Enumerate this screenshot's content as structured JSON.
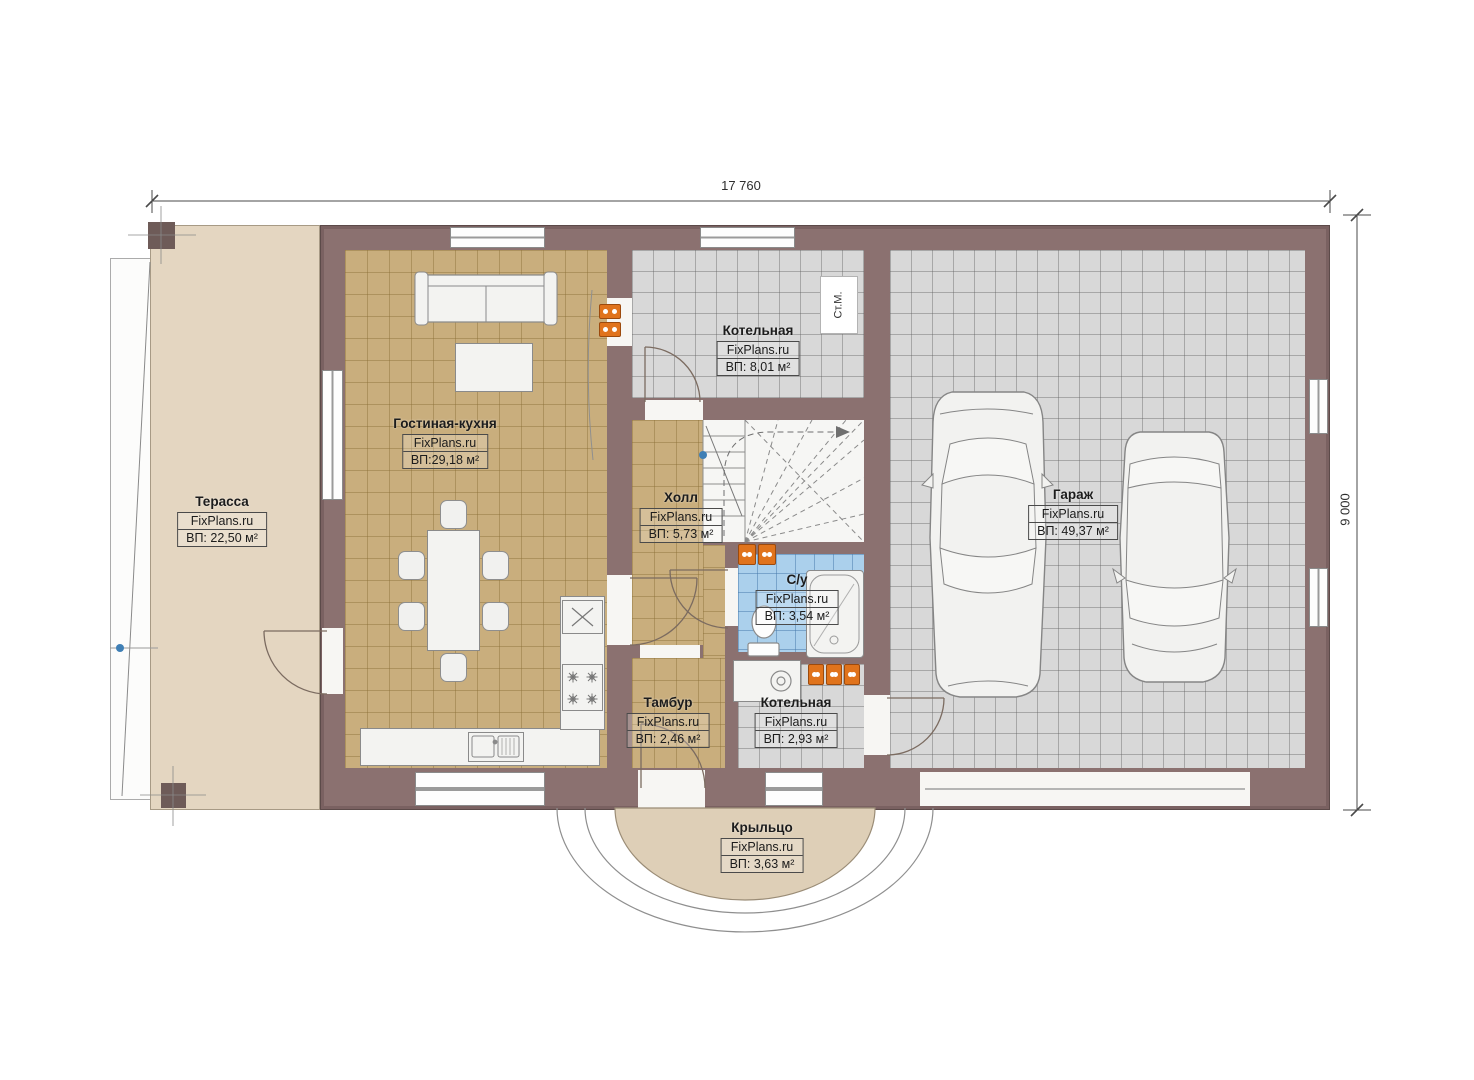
{
  "dimensions": {
    "width": "17 760",
    "height": "9 000"
  },
  "rooms": {
    "terrace": {
      "name": "Терасса",
      "brand": "FixPlans.ru",
      "area": "ВП: 22,50 м²"
    },
    "living": {
      "name": "Гостиная-кухня",
      "brand": "FixPlans.ru",
      "area": "ВП:29,18 м²"
    },
    "boiler_top": {
      "name": "Котельная",
      "brand": "FixPlans.ru",
      "area": "ВП: 8,01 м²"
    },
    "hall": {
      "name": "Холл",
      "brand": "FixPlans.ru",
      "area": "ВП: 5,73 м²"
    },
    "bath": {
      "name": "С/у",
      "brand": "FixPlans.ru",
      "area": "ВП: 3,54 м²"
    },
    "tambour": {
      "name": "Тамбур",
      "brand": "FixPlans.ru",
      "area": "ВП: 2,46 м²"
    },
    "boiler_bottom": {
      "name": "Котельная",
      "brand": "FixPlans.ru",
      "area": "ВП: 2,93 м²"
    },
    "garage": {
      "name": "Гараж",
      "brand": "FixPlans.ru",
      "area": "ВП: 49,37 м²"
    },
    "porch": {
      "name": "Крыльцо",
      "brand": "FixPlans.ru",
      "area": "ВП: 3,63 м²"
    }
  },
  "equipment": {
    "washing_machine_label": "Ст.М."
  },
  "colors": {
    "wall": "#8b7170",
    "floor_wood": "#c9ae7d",
    "floor_tile_gray": "#d8d8d8",
    "floor_bath": "#abd0ec",
    "terrace": "#e4d6c1",
    "porch": "#decfb7",
    "radiator": "#e0731c"
  }
}
